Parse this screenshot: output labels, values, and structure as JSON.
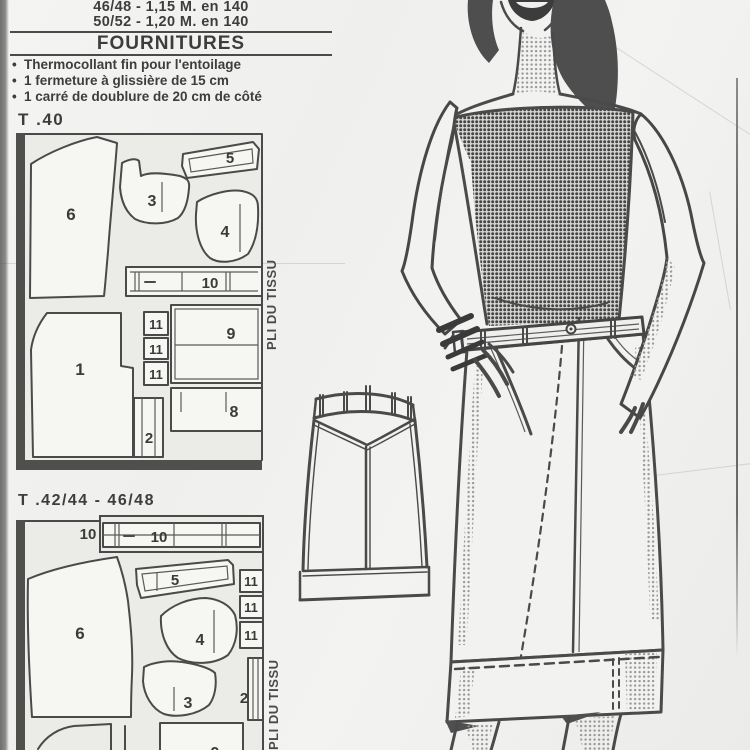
{
  "header": {
    "size_lines": [
      "46/48 - 1,15 M. en 140",
      "50/52 - 1,20 M. en 140"
    ]
  },
  "fournitures": {
    "title": "FOURNITURES",
    "bullet": "•",
    "items": [
      "Thermocollant fin pour l'entoilage",
      "1 fermeture à glissière de 15 cm",
      "1 carré de doublure de 20 cm de côté"
    ]
  },
  "layouts": [
    {
      "title": "T .40",
      "fold_label": "PLI DU TISSU",
      "piece_labels": {
        "p6": "6",
        "p3": "3",
        "p5": "5",
        "p4": "4",
        "p10": "10",
        "p1": "1",
        "p11a": "11",
        "p11b": "11",
        "p11c": "11",
        "p9": "9",
        "p2": "2",
        "p8": "8"
      }
    },
    {
      "title": "T .42/44 - 46/48",
      "fold_label": "PLI DU TISSU",
      "piece_labels": {
        "p10_out": "10",
        "p10": "10",
        "p6": "6",
        "p5": "5",
        "p4": "4",
        "p11a": "11",
        "p11b": "11",
        "p11c": "11",
        "p3": "3",
        "p2": "2",
        "p9": "9"
      }
    }
  ],
  "colors": {
    "ink": "#3d3d3d",
    "paper": "#f1f1ef"
  }
}
